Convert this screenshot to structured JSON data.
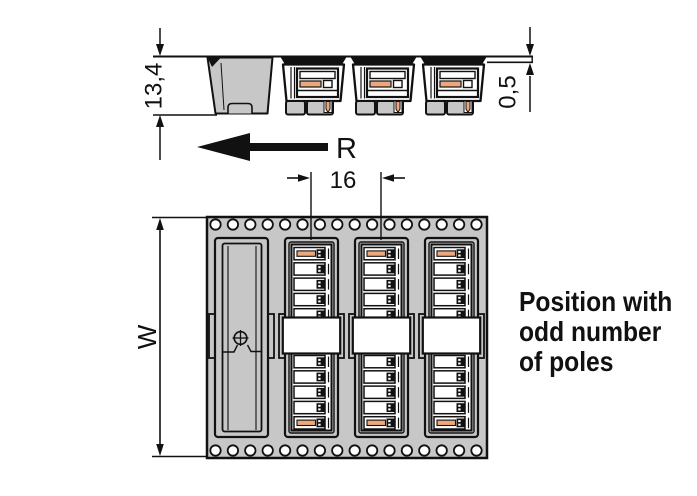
{
  "diagram": {
    "caption": {
      "lines": [
        "Position with",
        "odd number",
        "of poles"
      ]
    },
    "dimensions": {
      "height": "13,4",
      "tape_thickness": "0,5",
      "pocket_pitch": "16",
      "tape_width": "W",
      "unreeling_direction": "R"
    },
    "colors": {
      "tape_gray": "#c7c7c7",
      "actuator_orange": "#eca87a",
      "outline": "#111111",
      "white": "#ffffff"
    },
    "tape": {
      "sprocket_holes_per_row": 16,
      "hole_rows": 2,
      "pockets": 4,
      "empty_pockets": 1,
      "connectors": 3,
      "slots_per_half": 5
    }
  }
}
